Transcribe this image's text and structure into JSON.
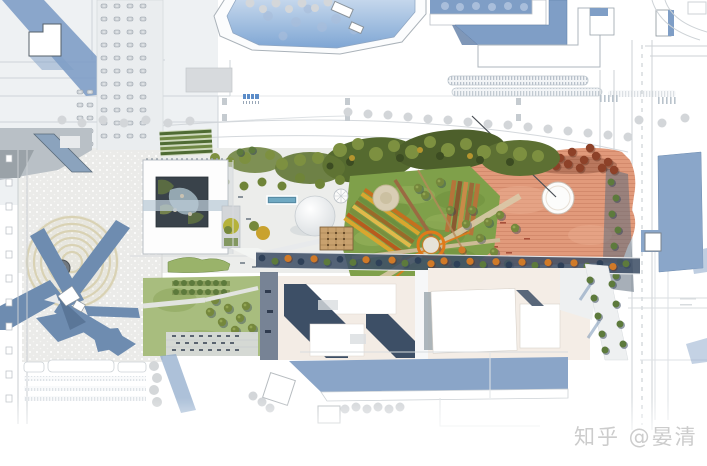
{
  "scene": {
    "type": "architectural-masterplan-rendering",
    "regions": [
      "stadium-bowl-north",
      "parking-lot-north",
      "convention-center-complex-northeast",
      "museum-courtyard-building",
      "central-dome-pavilion",
      "umbrella-tent",
      "timber-deck-pavilion",
      "reflecting-pool",
      "great-lawn",
      "striped-flower-beds",
      "orange-ring-sculpture",
      "terracotta-plaza",
      "white-circle-pavilion",
      "red-tree-grove",
      "tree-lined-boulevard",
      "monument-plaza-concentric-circles",
      "sculpture-shadow-spikes",
      "southwest-lawn-block",
      "office-blocks-south",
      "blue-slab-building-south",
      "road-network"
    ]
  },
  "palette": {
    "background": "#ffffff",
    "shadow_blue": "#84a1c8",
    "navy_shadow": "#3d4f66",
    "outline_gray": "#b9bfc5",
    "road_line": "#cdd2d6",
    "plaza_stipple": "#ebebe9",
    "plaza_gray": "#b9c0c6",
    "lawn_green": "#7fa04a",
    "lawn_light": "#a8bd7e",
    "tree_dark_green": "#4d5f2b",
    "tree_olive": "#75883c",
    "tree_orange": "#d07a28",
    "tree_red": "#8d4128",
    "terracotta": "#e19a7b",
    "terracotta_line": "#cf8466",
    "pavement_beige": "#d9d2b4",
    "water_teal": "#6fa9c2",
    "accent_orange": "#e07a1a",
    "deck_tan": "#c8a16e",
    "courtyard_slate": "#39424a",
    "watermark_gray": "#c7c7c7"
  },
  "watermark": {
    "text": "知乎 @晏清"
  }
}
